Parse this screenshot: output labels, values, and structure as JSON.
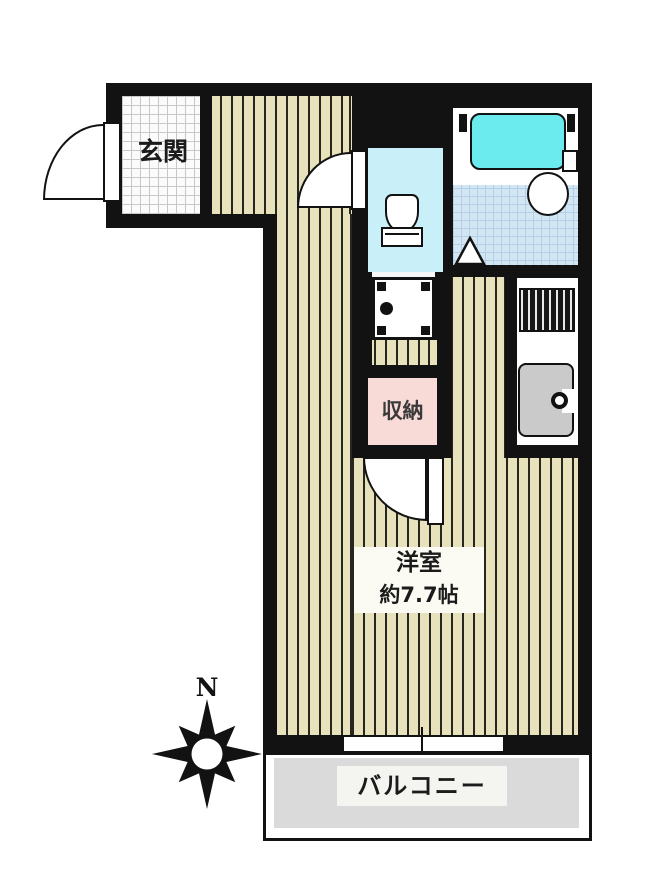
{
  "title": "間取り図",
  "labels": {
    "entrance": "玄関",
    "storage": "収納",
    "room_name": "洋室",
    "room_size": "約7.7帖",
    "balcony": "バルコニー",
    "compass_north": "N"
  },
  "rooms": {
    "main_room": {
      "name": "洋室",
      "size": "約7.7帖"
    },
    "entrance": "玄関",
    "storage": "収納",
    "balcony": "バルコニー"
  },
  "icons": {
    "compass": "compass-rose",
    "bathtub": "bathtub",
    "wash_basin": "wash-basin",
    "toilet": "toilet",
    "washing_machine": "washing-machine-pan",
    "gas_stove": "gas-stove",
    "kitchen_sink": "kitchen-sink",
    "door_arcs": "door-swing-arc",
    "window": "sliding-window"
  },
  "colors": {
    "wall": "#121212",
    "flooring": "#e7e1bc",
    "flooring_line": "#26261e",
    "entrance_tile": "#fbfbfb",
    "tile_grid": "#c8c8c8",
    "bath_tile": "#d3e6f4",
    "bath_grid": "#b4cee6",
    "toilet_floor": "#c9f0f8",
    "bathtub": "#6cebee",
    "storage_pink": "#f8dad6",
    "balcony_floor": "#dadada",
    "sink_gray": "#cacaca",
    "washer_floor": "#f7f7f7"
  }
}
